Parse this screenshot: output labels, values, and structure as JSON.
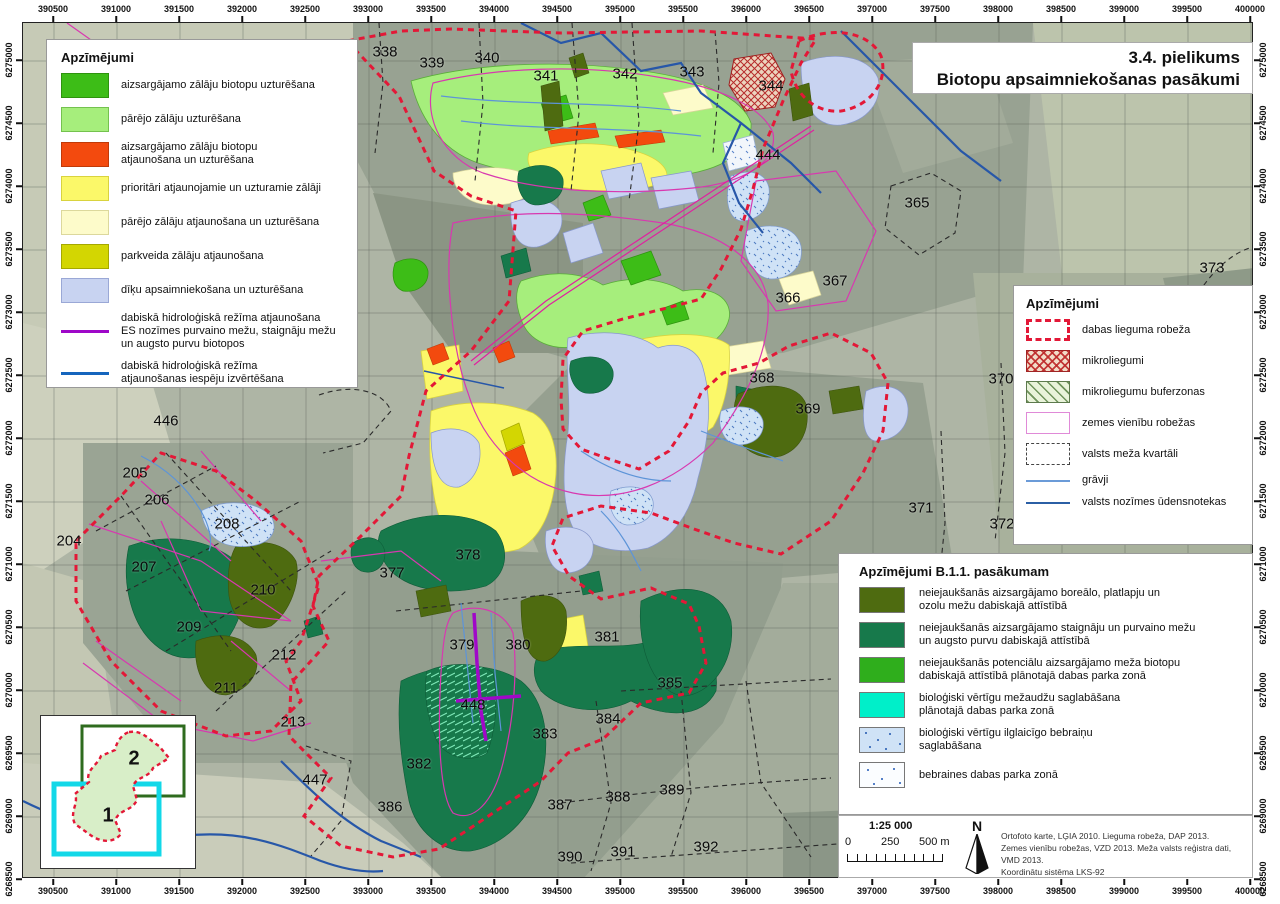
{
  "title": {
    "line1": "3.4. pielikums",
    "line2": "Biotopu apsaimniekošanas pasākumi"
  },
  "colors": {
    "reserve_boundary": "#e31837",
    "parcel_lines": "#d838b0",
    "quarter_lines": "#2a2a2a",
    "ditch": "#5d94d8",
    "watercourse": "#2757a8",
    "hydrology_restore": "#a008c8"
  },
  "legend_main": {
    "title": "Apzīmējumi",
    "items": [
      {
        "type": "fill",
        "color": "#3dbd17",
        "border": "#2e930e",
        "label": "aizsargājamo zālāju biotopu uzturēšana"
      },
      {
        "type": "fill",
        "color": "#a6ee7c",
        "border": "#74c24e",
        "label": "pārējo zālāju uzturēšana"
      },
      {
        "type": "fill",
        "color": "#f34a0e",
        "border": "#c03a08",
        "label": "aizsargājamo zālāju biotopu\natjaunošana un uzturēšana"
      },
      {
        "type": "fill",
        "color": "#fbf869",
        "border": "#d9d33e",
        "label": "prioritāri atjaunojamie un uzturamie zālāji"
      },
      {
        "type": "fill",
        "color": "#fdfbca",
        "border": "#dcd89c",
        "label": "pārējo zālāju atjaunošana un uzturēšana"
      },
      {
        "type": "fill",
        "color": "#d3d602",
        "border": "#a5a800",
        "label": "parkveida zālāju atjaunošana"
      },
      {
        "type": "fill",
        "color": "#c8d3f1",
        "border": "#9aa8d6",
        "label": "dīķu apsaimniekošana un uzturēšana"
      },
      {
        "type": "line",
        "color": "#9e08c8",
        "border": "#9e08c8",
        "label": "dabiskā hidroloģiskā režīma atjaunošana\nES nozīmes purvaino mežu, staignāju mežu\nun augsto purvu biotopos"
      },
      {
        "type": "line",
        "color": "#1565bd",
        "border": "#1565bd",
        "label": "dabiskā hidroloģiskā režīma\natjaunošanas iespēju izvērtēšana"
      }
    ]
  },
  "legend_boundaries": {
    "title": "Apzīmējumi",
    "items": [
      {
        "type": "dashed-red",
        "color": "#e31837",
        "label": "dabas lieguma robeža"
      },
      {
        "type": "crosshatch-red",
        "color": "#be2828",
        "label": "mikroliegumi"
      },
      {
        "type": "hatch-green",
        "color": "#5a8246",
        "label": "mikroliegumu buferzonas"
      },
      {
        "type": "outline-pink",
        "color": "#e08ad8",
        "label": "zemes vienību robežas"
      },
      {
        "type": "dashed-black",
        "color": "#444444",
        "label": "valsts meža kvartāli"
      },
      {
        "type": "line-light-blue",
        "color": "#6b9bd8",
        "label": "grāvji"
      },
      {
        "type": "line-dark-blue",
        "color": "#2b5fa5",
        "label": "valsts nozīmes ūdensnotekas"
      }
    ]
  },
  "legend_b11": {
    "title": "Apzīmējumi B.1.1. pasākumam",
    "items": [
      {
        "type": "fill",
        "color": "#4e6b10",
        "label": "neiejaukšanās aizsargājamo boreālo, platlapju un\nozolu mežu dabiskajā attīstībā"
      },
      {
        "type": "fill",
        "color": "#17794b",
        "label": "neiejaukšanās aizsargājamo staignāju un purvaino mežu\nun augsto purvu dabiskajā attīstībā"
      },
      {
        "type": "fill",
        "color": "#2fae1c",
        "label": "neiejaukšanās potenciālu aizsargājamo meža biotopu\ndabiskajā attīstībā plānotajā dabas parka zonā"
      },
      {
        "type": "fill",
        "color": "#00efc9",
        "label": "bioloģiski vērtīgu mežaudžu saglabāšana\nplānotajā dabas parka zonā"
      },
      {
        "type": "speckle-blue",
        "color": "#cfe2f6",
        "label": "bioloģiski vērtīgu ilglaicīgo  bebraiņu\nsaglabāšana"
      },
      {
        "type": "speckle-white",
        "color": "#fbfdff",
        "label": "bebraines dabas parka zonā"
      }
    ]
  },
  "scale": {
    "ratio": "1:25 000",
    "tick0": "0",
    "tick1": "250",
    "tick2": "500 m",
    "north": "N"
  },
  "credits": {
    "lines": [
      {
        "t": "Ortofoto karte, LĢIA 2010. Lieguma robeža, DAP 2013."
      },
      {
        "t": "Zemes vienību robežas, VZD 2013. Meža valsts reģistra dati, VMD 2013."
      },
      {
        "t": "Koordinātu sistēma LKS-92"
      }
    ]
  },
  "inset": {
    "area1": "1",
    "area2": "2"
  },
  "axes": {
    "x": [
      {
        "t": "390500",
        "x": 53
      },
      {
        "t": "391000",
        "x": 116
      },
      {
        "t": "391500",
        "x": 179
      },
      {
        "t": "392000",
        "x": 242
      },
      {
        "t": "392500",
        "x": 305
      },
      {
        "t": "393000",
        "x": 368
      },
      {
        "t": "393500",
        "x": 431
      },
      {
        "t": "394000",
        "x": 494
      },
      {
        "t": "394500",
        "x": 557
      },
      {
        "t": "395000",
        "x": 620
      },
      {
        "t": "395500",
        "x": 683
      },
      {
        "t": "396000",
        "x": 746
      },
      {
        "t": "396500",
        "x": 809
      },
      {
        "t": "397000",
        "x": 872
      },
      {
        "t": "397500",
        "x": 935
      },
      {
        "t": "398000",
        "x": 998
      },
      {
        "t": "398500",
        "x": 1061
      },
      {
        "t": "399000",
        "x": 1124
      },
      {
        "t": "399500",
        "x": 1187
      },
      {
        "t": "400000",
        "x": 1250
      }
    ],
    "y": [
      {
        "t": "6275000",
        "y": 60
      },
      {
        "t": "6274500",
        "y": 123
      },
      {
        "t": "6274000",
        "y": 186
      },
      {
        "t": "6273500",
        "y": 249
      },
      {
        "t": "6273000",
        "y": 312
      },
      {
        "t": "6272500",
        "y": 375
      },
      {
        "t": "6272000",
        "y": 438
      },
      {
        "t": "6271500",
        "y": 501
      },
      {
        "t": "6271000",
        "y": 564
      },
      {
        "t": "6270500",
        "y": 627
      },
      {
        "t": "6270000",
        "y": 690
      },
      {
        "t": "6269500",
        "y": 753
      },
      {
        "t": "6269000",
        "y": 816
      },
      {
        "t": "6268500",
        "y": 879
      }
    ]
  },
  "map_labels": [
    {
      "t": "338",
      "x": 385,
      "y": 52
    },
    {
      "t": "339",
      "x": 432,
      "y": 63
    },
    {
      "t": "340",
      "x": 487,
      "y": 58
    },
    {
      "t": "341",
      "x": 546,
      "y": 76
    },
    {
      "t": "342",
      "x": 625,
      "y": 74
    },
    {
      "t": "343",
      "x": 692,
      "y": 72
    },
    {
      "t": "344",
      "x": 771,
      "y": 86
    },
    {
      "t": "444",
      "x": 768,
      "y": 155
    },
    {
      "t": "365",
      "x": 917,
      "y": 203
    },
    {
      "t": "373",
      "x": 1212,
      "y": 268
    },
    {
      "t": "366",
      "x": 788,
      "y": 298
    },
    {
      "t": "367",
      "x": 835,
      "y": 281
    },
    {
      "t": "368",
      "x": 762,
      "y": 378
    },
    {
      "t": "369",
      "x": 808,
      "y": 409
    },
    {
      "t": "370",
      "x": 1001,
      "y": 379
    },
    {
      "t": "371",
      "x": 921,
      "y": 508
    },
    {
      "t": "372",
      "x": 1002,
      "y": 524
    },
    {
      "t": "446",
      "x": 166,
      "y": 421
    },
    {
      "t": "205",
      "x": 135,
      "y": 473
    },
    {
      "t": "206",
      "x": 157,
      "y": 500
    },
    {
      "t": "208",
      "x": 227,
      "y": 524
    },
    {
      "t": "204",
      "x": 69,
      "y": 541
    },
    {
      "t": "207",
      "x": 144,
      "y": 567
    },
    {
      "t": "210",
      "x": 263,
      "y": 590
    },
    {
      "t": "209",
      "x": 189,
      "y": 627
    },
    {
      "t": "212",
      "x": 284,
      "y": 655
    },
    {
      "t": "211",
      "x": 226,
      "y": 688
    },
    {
      "t": "213",
      "x": 293,
      "y": 722
    },
    {
      "t": "447",
      "x": 315,
      "y": 780
    },
    {
      "t": "377",
      "x": 392,
      "y": 573
    },
    {
      "t": "378",
      "x": 468,
      "y": 555
    },
    {
      "t": "379",
      "x": 462,
      "y": 645
    },
    {
      "t": "380",
      "x": 518,
      "y": 645
    },
    {
      "t": "381",
      "x": 607,
      "y": 637
    },
    {
      "t": "385",
      "x": 670,
      "y": 683
    },
    {
      "t": "448",
      "x": 473,
      "y": 705
    },
    {
      "t": "383",
      "x": 545,
      "y": 734
    },
    {
      "t": "384",
      "x": 608,
      "y": 719
    },
    {
      "t": "382",
      "x": 419,
      "y": 764
    },
    {
      "t": "386",
      "x": 390,
      "y": 807
    },
    {
      "t": "387",
      "x": 560,
      "y": 805
    },
    {
      "t": "388",
      "x": 618,
      "y": 797
    },
    {
      "t": "389",
      "x": 672,
      "y": 790
    },
    {
      "t": "390",
      "x": 570,
      "y": 857
    },
    {
      "t": "391",
      "x": 623,
      "y": 852
    },
    {
      "t": "392",
      "x": 706,
      "y": 847
    }
  ]
}
